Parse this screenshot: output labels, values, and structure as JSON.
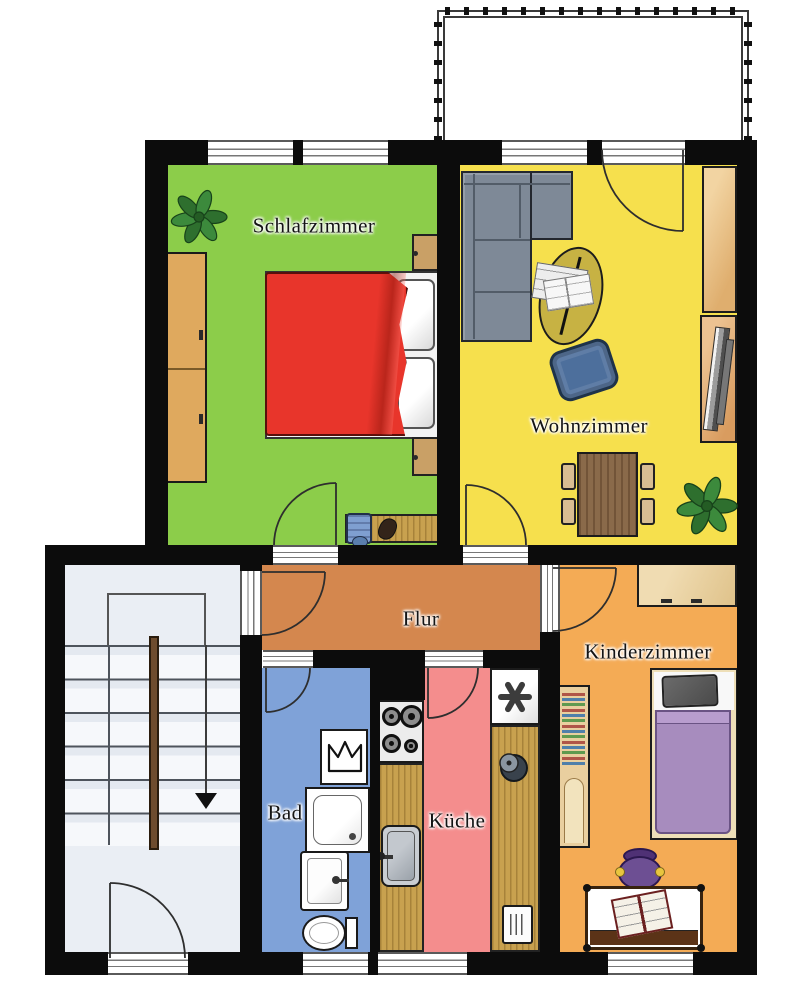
{
  "plan": {
    "type": "apartment-floor-plan",
    "language": "de"
  },
  "rooms": [
    {
      "id": "schlafzimmer",
      "label": "Schlafzimmer",
      "floor_color": "#8ccd4a",
      "furniture": [
        "double-bed",
        "red-duvet",
        "pillows",
        "wardrobe",
        "nightstand",
        "nightstand",
        "desk",
        "desk-chair",
        "potted-plant"
      ]
    },
    {
      "id": "wohnzimmer",
      "label": "Wohnzimmer",
      "floor_color": "#f6e04d",
      "furniture": [
        "corner-sofa",
        "coffee-table",
        "newspapers",
        "ottoman",
        "dining-table",
        "dining-chair",
        "dining-chair",
        "dining-chair",
        "dining-chair",
        "sideboard",
        "tv-lowboard",
        "tv",
        "potted-plant"
      ]
    },
    {
      "id": "flur",
      "label": "Flur",
      "floor_color": "#d4874e",
      "furniture": []
    },
    {
      "id": "bad",
      "label": "Bad",
      "floor_color": "#7fa2d8",
      "furniture": [
        "washing-machine",
        "shower",
        "wash-basin",
        "toilet"
      ]
    },
    {
      "id": "kueche",
      "label": "Küche",
      "floor_color": "#f48d8d",
      "furniture": [
        "stove",
        "kitchen-counter",
        "kitchen-sink",
        "kitchen-counter",
        "freezer",
        "pot",
        "radiator"
      ]
    },
    {
      "id": "kinderzimmer",
      "label": "Kinderzimmer",
      "floor_color": "#f4ab55",
      "furniture": [
        "single-bed",
        "dresser",
        "bookshelf",
        "kids-desk",
        "kids-chair",
        "open-book"
      ]
    }
  ],
  "outside": {
    "balcony": {
      "present": true
    },
    "stairwell": {
      "features": [
        "stairs",
        "center-handrail",
        "half-landing",
        "direction-arrow-down",
        "building-entrance-door",
        "apartment-entrance-door"
      ]
    }
  },
  "palette": {
    "wall": "#0c0c0c",
    "stairwell_floor": "#eaeef4",
    "window_line": "#5a5a5a",
    "wood_light": "#e9cf9f",
    "wood_wardrobe": "#dfa95e",
    "wood_counter": "#c8a14f",
    "wood_table": "#8a6a4a",
    "bed_red": "#e8352b",
    "sofa_gray": "#7e8997",
    "ottoman_blue": "#4d6f9c",
    "kid_bed_purple": "#a78cbe",
    "coffee_table_olive": "#c7b243"
  }
}
